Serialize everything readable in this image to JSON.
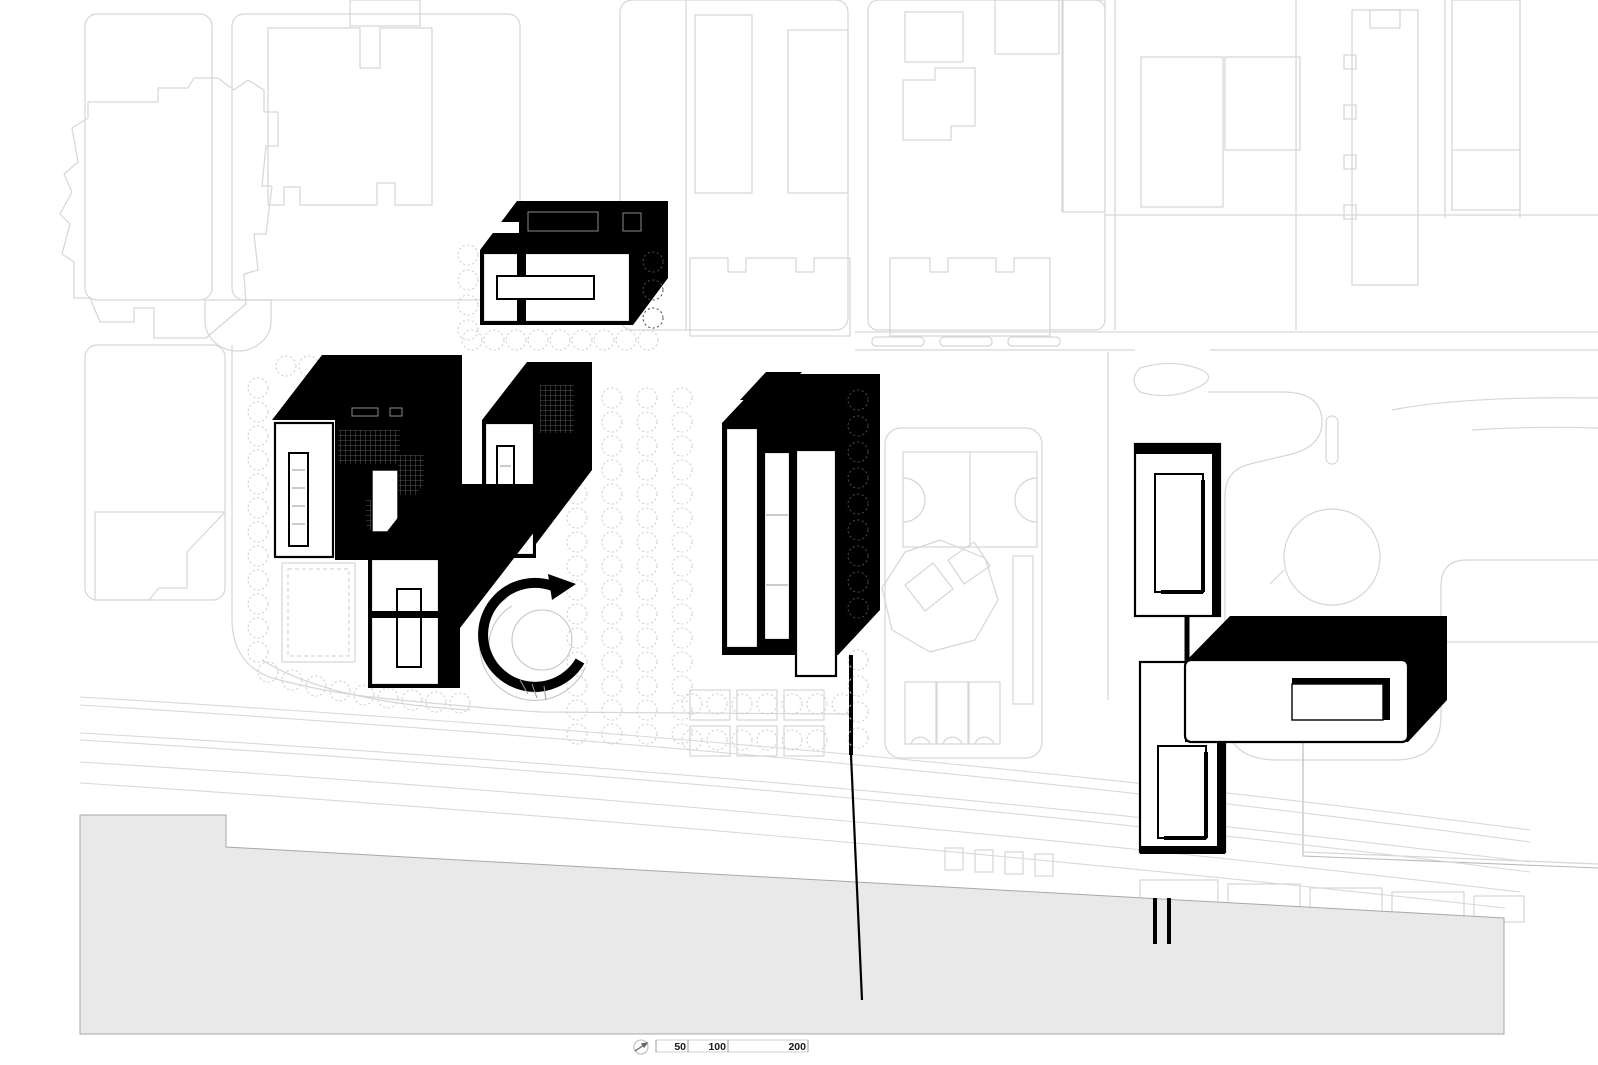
{
  "drawing": {
    "type": "architectural-masterplan-site-plan",
    "style": "black proposed buildings in axonometric over light gray context line work, water band at bottom"
  },
  "colors": {
    "background": "#ffffff",
    "context_line": "#d6d6d6",
    "proposed_building": "#000000",
    "water_fill": "#e9e9e9",
    "water_edge": "#a8a8a8",
    "tree_line": "#cdcdcd"
  },
  "scale_bar": {
    "labels": [
      "50",
      "100",
      "200"
    ],
    "icon": "north-arrow-icon"
  }
}
